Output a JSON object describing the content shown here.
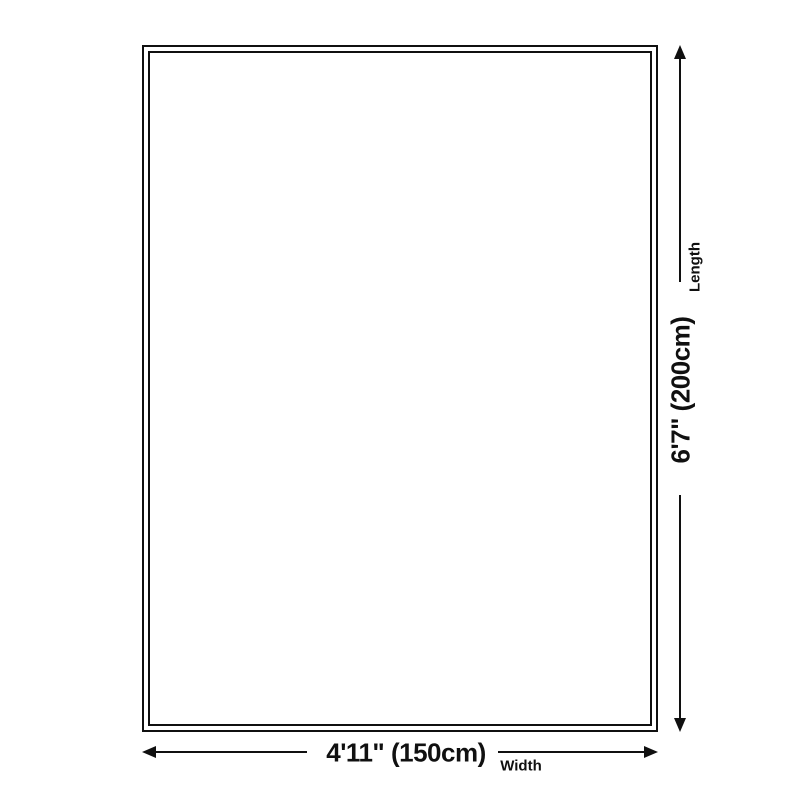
{
  "diagram": {
    "palette": {
      "background": "#ffffff",
      "line_color": "#101010"
    },
    "length": {
      "value": "6'7\" (200cm)",
      "axis_label": "Length"
    },
    "width": {
      "value": "4'11\" (150cm)",
      "axis_label": "Width"
    }
  }
}
